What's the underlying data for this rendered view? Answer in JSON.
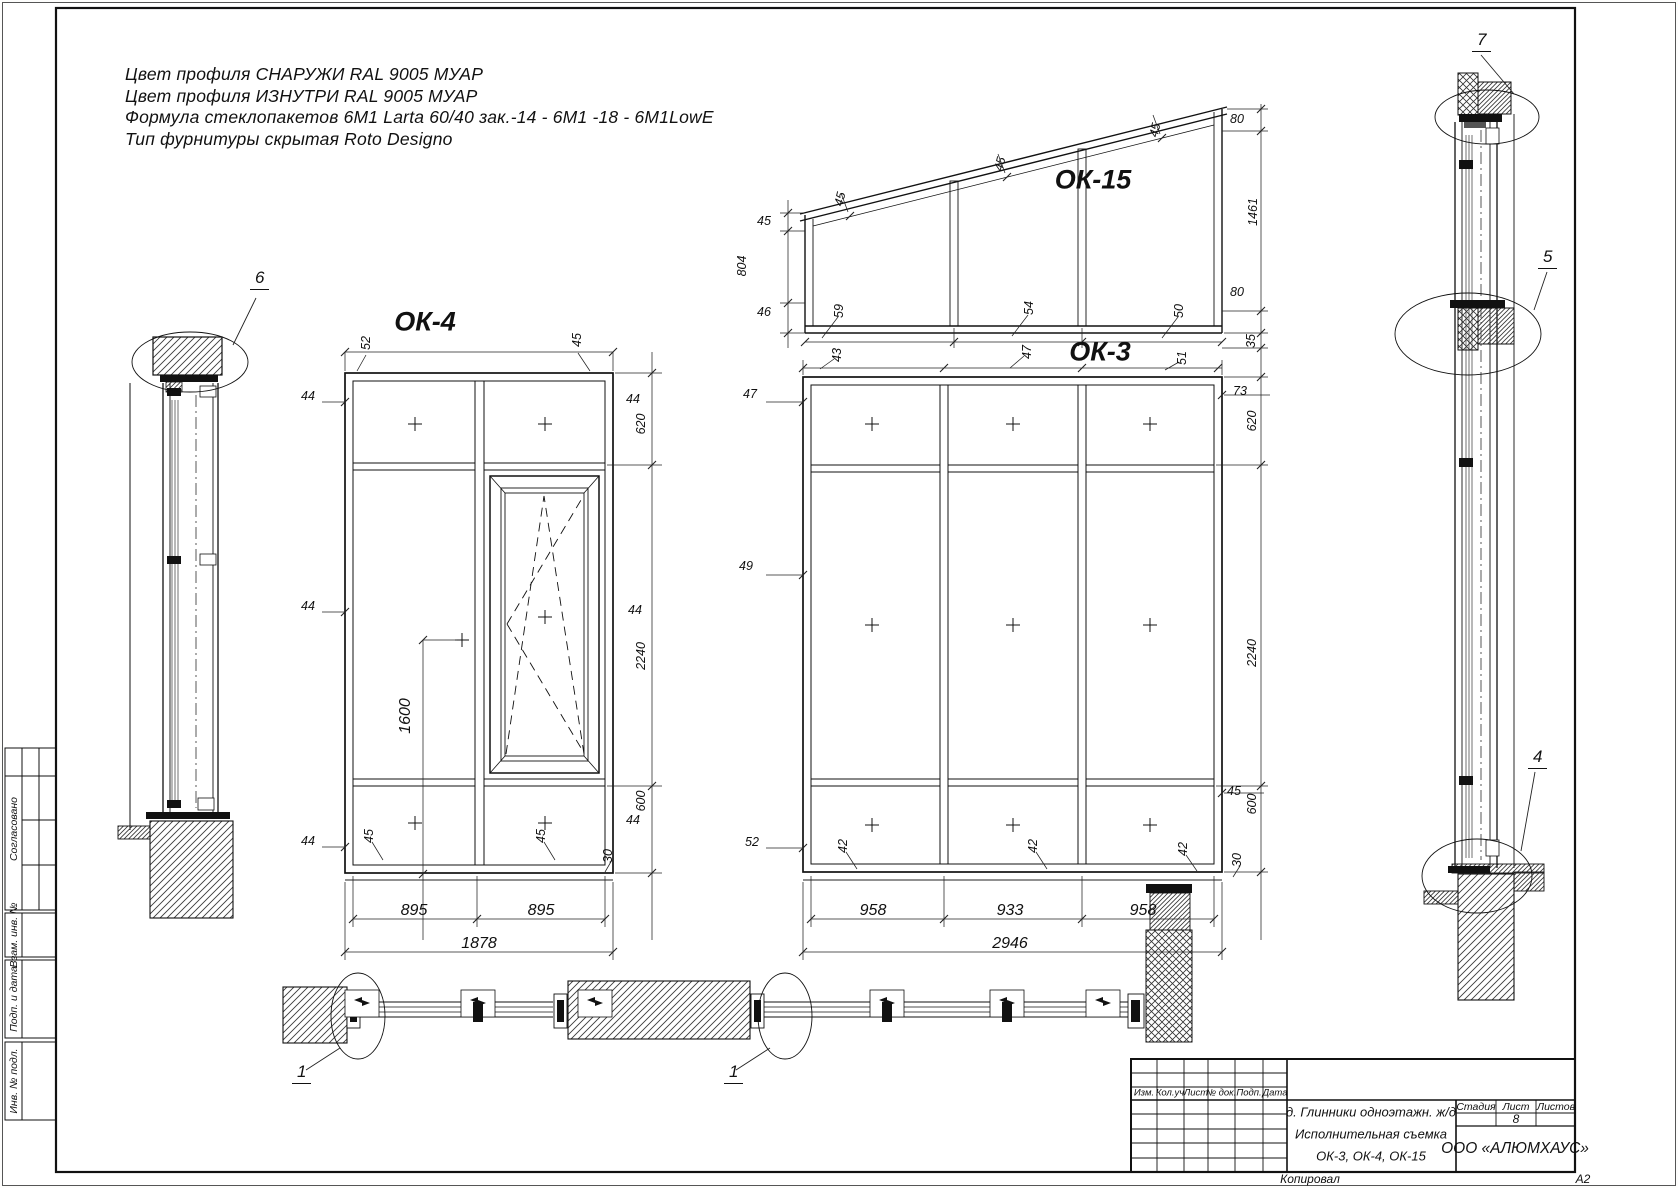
{
  "specs": [
    "Цвет профиля СНАРУЖИ RAL 9005 МУАР",
    "Цвет профиля ИЗНУТРИ RAL 9005 МУАР",
    "Формула стеклопакетов 6М1 Larta 60/40 зак.-14 - 6М1 -18 - 6М1LowE",
    "Тип фурнитуры скрытая Roto Designo"
  ],
  "ok4": {
    "title": "ОК-4",
    "dims": {
      "top": [
        "52",
        "45"
      ],
      "left": [
        "44",
        "44",
        "44"
      ],
      "right": [
        "44",
        "620",
        "44",
        "2240",
        "600",
        "44"
      ],
      "bottom": [
        "45",
        "45"
      ],
      "widths": [
        "895",
        "895"
      ],
      "total": "1878",
      "handle_height": "1600",
      "sill": "30"
    }
  },
  "ok3": {
    "title": "ОК-3",
    "dims": {
      "top": [
        "43",
        "47",
        "51"
      ],
      "left": [
        "47",
        "49",
        "52"
      ],
      "right": [
        "73",
        "45"
      ],
      "right_col": [
        "620",
        "2240",
        "600"
      ],
      "bottom": [
        "42",
        "42",
        "42"
      ],
      "widths": [
        "958",
        "933",
        "958"
      ],
      "total": "2946",
      "sill": "30"
    }
  },
  "ok15": {
    "title": "ОК-15",
    "dims": {
      "left": [
        "45",
        "804",
        "46"
      ],
      "slope": [
        "45",
        "45",
        "45"
      ],
      "bottom": [
        "59",
        "54",
        "50"
      ],
      "right": [
        "80",
        "1461",
        "80",
        "35"
      ]
    }
  },
  "callouts": {
    "n1": "1",
    "n4": "4",
    "n5": "5",
    "n6": "6",
    "n7": "7"
  },
  "stamp": {
    "rev_cols": [
      "Изм.",
      "Кол.уч",
      "Лист",
      "№ док.",
      "Подп.",
      "Дата"
    ],
    "project": "д. Глинники одноэтажн. ж/д",
    "survey": "Исполнительная съемка",
    "items": "ОК-3, ОК-4, ОК-15",
    "stage_label": "Стадия",
    "sheet_label": "Лист",
    "sheets_label": "Листов",
    "sheet_no": "8",
    "company": "ООО «АЛЮМХАУС»"
  },
  "margin": {
    "agreed": "Согласовано",
    "vzam": "Взам. инв. №",
    "podp": "Подп. и дата",
    "inv": "Инв. № подл."
  },
  "footer": {
    "copied": "Копировал",
    "format": "А2"
  }
}
